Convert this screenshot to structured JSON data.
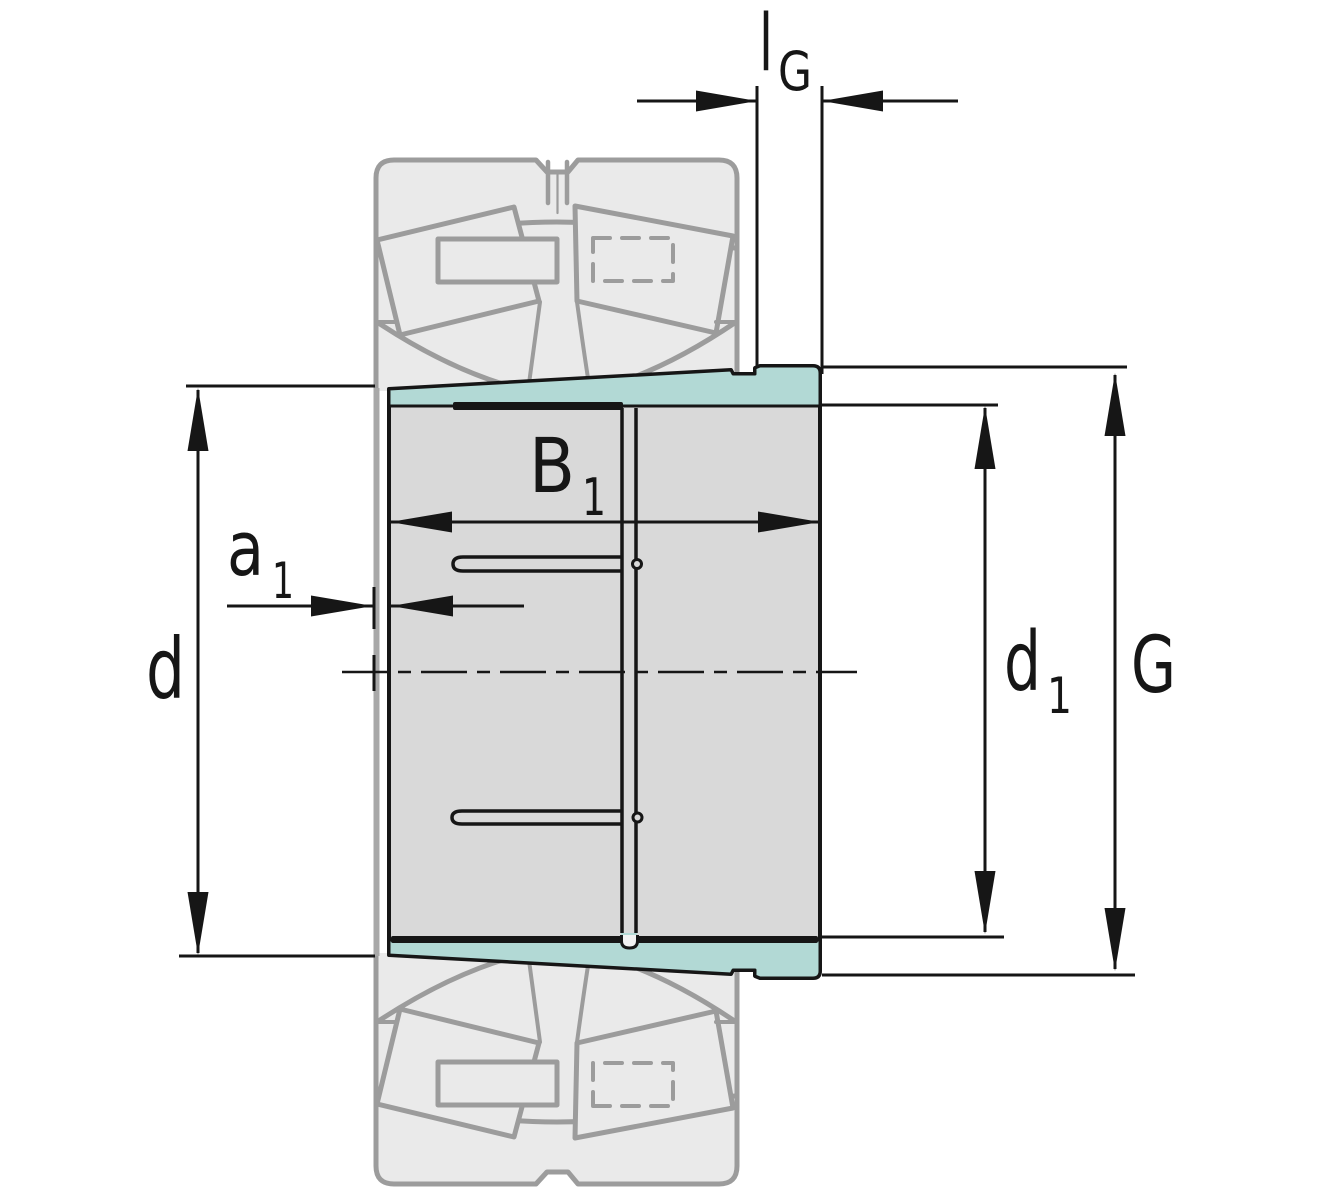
{
  "diagram": {
    "kind": "adapter-sleeve-dimension-drawing",
    "dimensions": {
      "lg": {
        "main": "l",
        "sub": "G"
      },
      "b1": {
        "main": "B",
        "sub": "1"
      },
      "a1": {
        "main": "a",
        "sub": "1"
      },
      "d": {
        "main": "d"
      },
      "d1": {
        "main": "d",
        "sub": "1"
      },
      "g": {
        "main": "G"
      }
    },
    "colors": {
      "background": "#ffffff",
      "highlight": "#b2d9d5",
      "sleeve_fill": "#d9d9d9",
      "ghost_fill": "#eaeaea",
      "ghost_stroke": "#9c9c9c",
      "outline": "#161616"
    }
  }
}
